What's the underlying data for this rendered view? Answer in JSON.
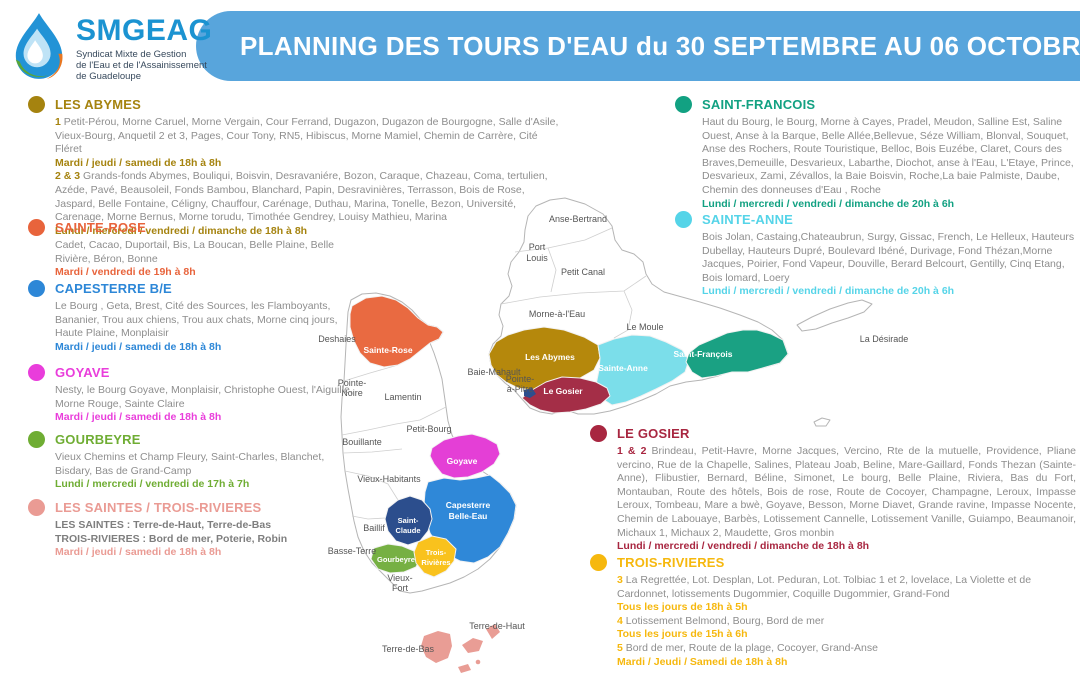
{
  "header": {
    "logo": {
      "name": "SMGEAG",
      "subtitle": [
        "Syndicat Mixte de Gestion",
        "de l'Eau et de l'Assainissement",
        "de Guadeloupe"
      ]
    },
    "title": "PLANNING DES TOURS D'EAU du 30 SEPTEMBRE AU 06 OCTOBRE 20",
    "banner_color": "#58a5dc"
  },
  "sections": [
    {
      "id": "les-abymes",
      "title": "LES ABYMES",
      "color": "#a5830f",
      "paragraphs": [
        {
          "type": "areas",
          "prefix": "1",
          "text": "Petit-Pérou, Morne Caruel, Morne Vergain, Cour Ferrand, Dugazon, Dugazon de Bourgogne, Salle d'Asile, Vieux-Bourg, Anquetil 2 et 3, Pages, Cour Tony, RN5, Hibiscus, Morne Mamiel, Chemin de Carrère, Cité Fléret"
        },
        {
          "type": "schedule",
          "text": "Mardi / jeudi / samedi de 18h à 8h"
        },
        {
          "type": "areas",
          "prefix": "2 & 3",
          "text": "Grands-fonds Abymes, Bouliqui, Boisvin, Desravaniére, Bozon, Caraque, Chazeau, Coma, tertulien, Azéde, Pavé, Beausoleil, Fonds Bambou, Blanchard, Papin, Desravinières, Terrasson, Bois de Rose, Jaspard, Belle Fontaine, Céligny, Chauffour, Carénage, Duthau, Marina, Tonelle, Bezon, Université, Carenage, Morne Bernus, Morne torudu, Timothée Gendrey, Louisy Mathieu, Marina"
        },
        {
          "type": "schedule",
          "text": "Lundi / mercredi / vendredi / dimanche de 18h à 8h"
        }
      ]
    },
    {
      "id": "sainte-rose",
      "title": "SAINTE-ROSE",
      "color": "#e8643c",
      "paragraphs": [
        {
          "type": "areas",
          "text": "Cadet, Cacao, Duportail, Bis, La Boucan, Belle Plaine, Belle Rivière, Béron, Bonne"
        },
        {
          "type": "schedule",
          "text": "Mardi / vendredi de 19h à 8h"
        }
      ]
    },
    {
      "id": "capesterre-be",
      "title": "CAPESTERRE B/E",
      "color": "#2d87d7",
      "paragraphs": [
        {
          "type": "areas",
          "text": "Le Bourg , Geta, Brest, Cité des Sources, les Flamboyants, Bananier, Trou aux chiens, Trou aux chats, Morne cinq jours, Haute Plaine, Monplaisir"
        },
        {
          "type": "schedule",
          "text": "Mardi / jeudi / samedi de 18h à 8h"
        }
      ]
    },
    {
      "id": "goyave",
      "title": "GOYAVE",
      "color": "#e93ddb",
      "paragraphs": [
        {
          "type": "areas",
          "text": "Nesty, le Bourg Goyave, Monplaisir, Christophe Ouest, l'Aiguille, Morne Rouge, Sainte Claire"
        },
        {
          "type": "schedule",
          "text": "Mardi / jeudi / samedi de 18h à 8h"
        }
      ]
    },
    {
      "id": "gourbeyre",
      "title": "GOURBEYRE",
      "color": "#6fad33",
      "paragraphs": [
        {
          "type": "areas",
          "text": "Vieux Chemins et Champ Fleury,  Saint-Charles, Blanchet, Bisdary, Bas de Grand-Camp"
        },
        {
          "type": "schedule",
          "text": "Lundi / mercredi / vendredi de 17h à 7h"
        }
      ]
    },
    {
      "id": "les-saintes-trois-rivieres",
      "title": "LES SAINTES / TROIS-RIVIERES",
      "color": "#ea9b94",
      "paragraphs": [
        {
          "type": "areas-bold",
          "text": "LES SAINTES : Terre-de-Haut, Terre-de-Bas"
        },
        {
          "type": "areas-bold",
          "text": "TROIS-RIVIERES : Bord de mer, Poterie, Robin"
        },
        {
          "type": "schedule",
          "text": "Mardi / jeudi / samedi de 18h à 8h"
        }
      ]
    },
    {
      "id": "saint-francois",
      "title": "SAINT-FRANCOIS",
      "color": "#12a182",
      "paragraphs": [
        {
          "type": "areas",
          "text": "Haut du Bourg, le Bourg, Morne à Cayes, Pradel, Meudon, Salline Est, Saline Ouest, Anse à la Barque, Belle Allée,Bellevue, Séze William, Blonval, Souquet, Anse des Rochers, Route Touristique, Belloc, Bois Euzébe, Claret, Cours des Braves,Demeuille, Desvarieux, Labarthe, Diochot, anse à l'Eau,  L'Etaye, Prince, Desvarieux, Zami, Zévallos,  la Baie Boisvin, Roche,La baie Palmiste, Daube, Chemin des donneuses d'Eau , Roche"
        },
        {
          "type": "schedule",
          "text": "Lundi / mercredi / vendredi / dimanche de 20h à 6h"
        }
      ]
    },
    {
      "id": "sainte-anne",
      "title": "SAINTE-ANNE",
      "color": "#55d4e8",
      "paragraphs": [
        {
          "type": "areas",
          "text": "Bois Jolan, Castaing,Chateaubrun, Surgy, Gissac, French, Le Helleux, Hauteurs Dubellay, Hauteurs Dupré, Boulevard Ibéné, Durivage, Fond Thézan,Morne Jacques, Poirier, Fond Vapeur, Douville, Berard Belcourt, Gentilly, Cinq Etang, Bois lomard, Loery"
        },
        {
          "type": "schedule",
          "text": "Lundi / mercredi / vendredi / dimanche de 20h à 6h"
        }
      ]
    },
    {
      "id": "le-gosier",
      "title": "LE GOSIER",
      "color": "#a82640",
      "justify": true,
      "paragraphs": [
        {
          "type": "areas",
          "prefix": "1 & 2",
          "text": "Brindeau, Petit-Havre, Morne Jacques, Vercino, Rte de la mutuelle, Providence, Pliane vercino, Rue de la Chapelle, Salines, Plateau Joab,  Beline, Mare-Gaillard, Fonds Thezan (Sainte-Anne), Flibustier, Bernard, Béline, Simonet, Le bourg, Belle Plaine, Riviera, Bas du Fort, Montauban, Route des hôtels, Bois de rose, Route de Cocoyer, Champagne, Leroux, Impasse Leroux, Tombeau, Mare a bwè, Goyave, Besson, Morne Diavet, Grande ravine, Impasse Nocente, Chemin de Labouaye, Barbès, Lotissement Cannelle, Lotissement Vanille, Guiampo, Beaumanoir, Michaux 1, Michaux 2, Maudette, Gros monbin"
        },
        {
          "type": "schedule",
          "text": "Lundi / mercredi / vendredi / dimanche de 18h à 8h"
        }
      ]
    },
    {
      "id": "trois-rivieres",
      "title": "TROIS-RIVIERES",
      "color": "#f6b80e",
      "paragraphs": [
        {
          "type": "areas",
          "prefix": "3",
          "text": "La Regrettée, Lot. Desplan, Lot. Peduran, Lot. Tolbiac 1 et 2, lovelace, La Violette et de Cardonnet, lotissements Dugommier, Coquille Dugommier, Grand-Fond"
        },
        {
          "type": "schedule",
          "text": "Tous les jours de 18h à 5h"
        },
        {
          "type": "areas",
          "prefix": "4",
          "text": "Lotissement Belmond, Bourg, Bord de mer"
        },
        {
          "type": "schedule",
          "text": "Tous les jours de 15h à 6h"
        },
        {
          "type": "areas",
          "prefix": "5",
          "text": "Bord de mer, Route de la plage, Cocoyer, Grand-Anse"
        },
        {
          "type": "schedule",
          "text": "Mardi / Jeudi / Samedi de 18h à 8h"
        }
      ]
    }
  ],
  "map": {
    "colors": {
      "sainte_rose": "#e96a41",
      "les_abymes": "#b5880c",
      "sainte_anne": "#7bdeea",
      "saint_francois": "#1aa183",
      "le_gosier": "#a42e47",
      "goyave": "#e43fd6",
      "capesterre": "#2f88d8",
      "saint_claude": "#2c4e8d",
      "gourbeyre": "#76b043",
      "trois_rivieres": "#f9c21d",
      "les_saintes": "#e99d95",
      "pap_marker": "#2c4e8d"
    },
    "region_labels": {
      "sainte_rose": "Sainte-Rose",
      "les_abymes": "Les Abymes",
      "sainte_anne": "Sainte-Anne",
      "saint_francois": "Saint-François",
      "le_gosier": "Le Gosier",
      "goyave": "Goyave",
      "capesterre_1": "Capesterre",
      "capesterre_2": "Belle-Eau",
      "saint_claude_1": "Saint-",
      "saint_claude_2": "Claude",
      "gourbeyre": "Gourbeyre",
      "trois_rivieres_1": "Trois-",
      "trois_rivieres_2": "Rivières"
    },
    "place_labels": {
      "anse_bertrand": "Anse-Bertrand",
      "port_louis_1": "Port",
      "port_louis_2": "Louis",
      "petit_canal": "Petit Canal",
      "morne_a_leau": "Morne-à-l'Eau",
      "le_moule": "Le Moule",
      "la_desirade": "La Désirade",
      "deshaies": "Deshaies",
      "pointe_noire_1": "Pointe-",
      "pointe_noire_2": "Noire",
      "lamentin": "Lamentin",
      "baie_mahault": "Baie-Mahault",
      "pointe_a_pitre_1": "Pointe-",
      "pointe_a_pitre_2": "à-Pitre",
      "petit_bourg": "Petit-Bourg",
      "bouillante": "Bouillante",
      "vieux_habitants": "Vieux-Habitants",
      "baillif": "Baillif",
      "basse_terre": "Basse-Terre",
      "vieux_fort_1": "Vieux-",
      "vieux_fort_2": "Fort",
      "terre_de_haut": "Terre-de-Haut",
      "terre_de_bas": "Terre-de-Bas"
    }
  }
}
